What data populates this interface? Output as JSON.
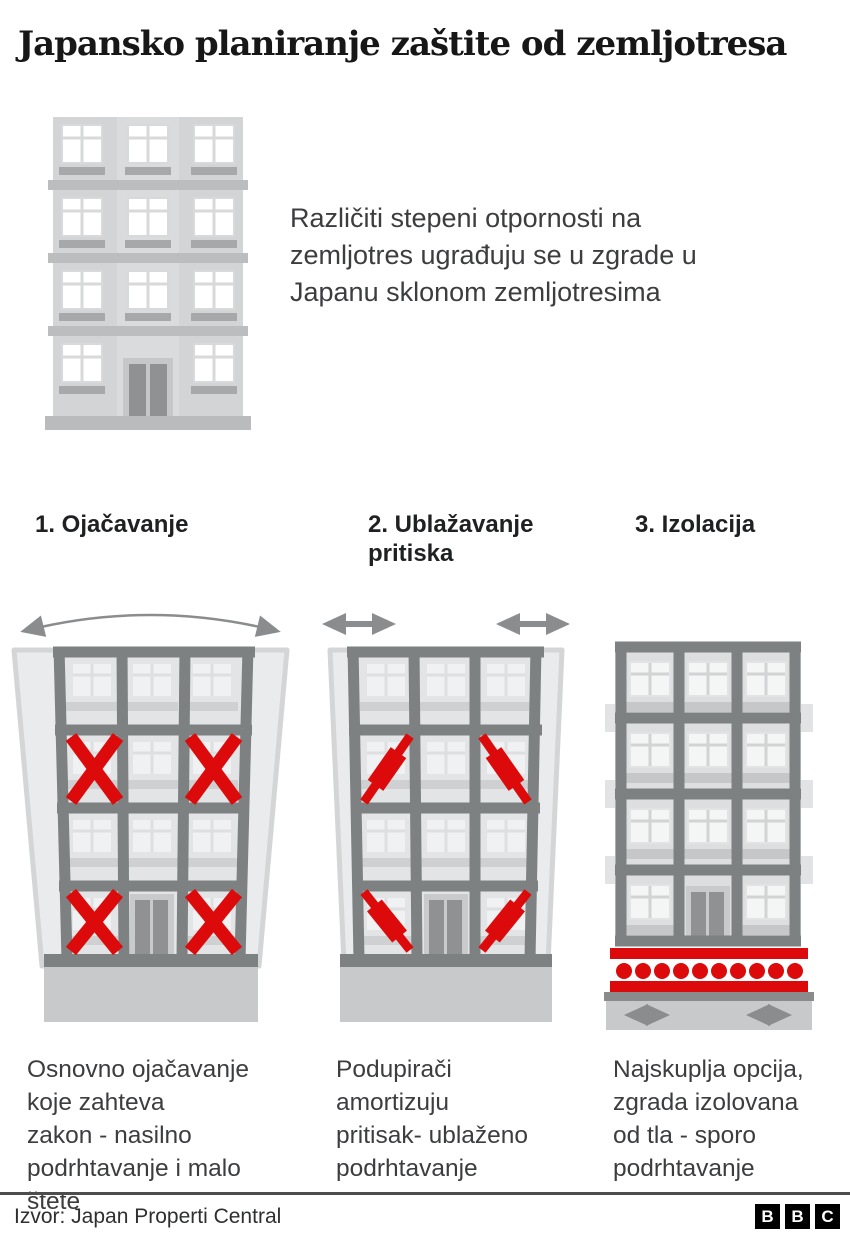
{
  "title": "Japansko planiranje zaštite od zemljotresa",
  "intro": {
    "text": "Različiti stepeni otpornosti na\nzemljotres ugrađuju se u zgrade u\nJapanu sklonom zemljotresima"
  },
  "methods": [
    {
      "heading": "1. Ojačavanje",
      "description": "Osnovno ojačavanje\nkoje zahteva\nzakon - nasilno\npodrhtavanje i malo\nštete"
    },
    {
      "heading": "2. Ublažavanje\npritiska",
      "description": "Podupirači\namortizuju\npritisak- ublaženo\npodrhtavanje"
    },
    {
      "heading": "3. Izolacija",
      "description": "Najskuplja opcija,\nzgrada izolovana\nod tla - sporo\npodrhtavanje"
    }
  ],
  "footer": {
    "source": "Izvor: Japan Properti Central",
    "logo_letters": [
      "B",
      "B",
      "C"
    ]
  },
  "icons": {
    "sway_arrow": "curved-double-headed-arrow",
    "shake_arrow": "horizontal-double-headed-arrow",
    "x_brace": "red-x-cross-brace",
    "damper": "red-diagonal-shock-absorber",
    "rollers": "row-of-red-isolation-bearings",
    "ground_arrow": "horizontal-double-headed-arrow"
  },
  "colors": {
    "accent_red": "#dc0a0a",
    "frame_gray": "#7e8182",
    "building_gray": "#d3d4d5",
    "ghost_gray": "#eaebec",
    "base_gray": "#c8c9ca",
    "arrow_gray": "#8a8c8d",
    "text_dark": "#3c3d3f",
    "title_black": "#171717",
    "divider_gray": "#4d4d4d",
    "logo_bg": "#000000",
    "logo_text": "#ffffff"
  }
}
